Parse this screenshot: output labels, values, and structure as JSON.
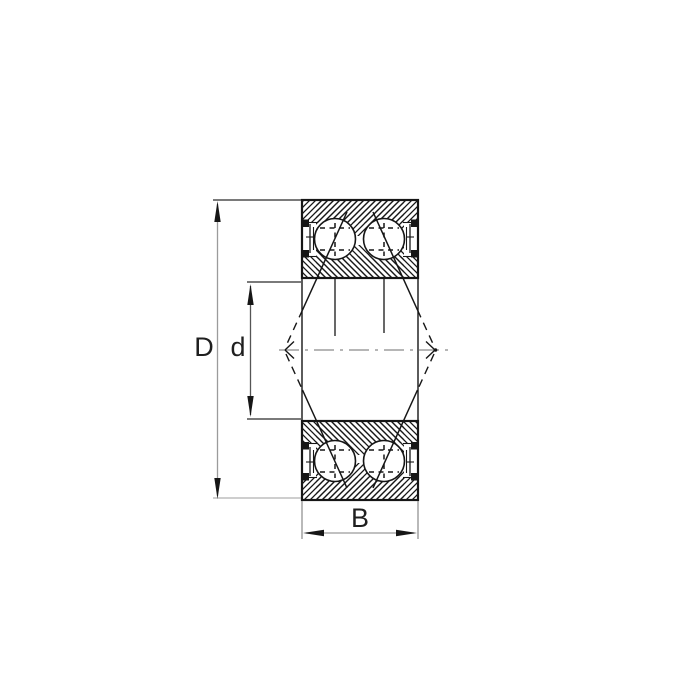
{
  "figure": {
    "dimensions": {
      "outer_diameter_label": "D",
      "bore_diameter_label": "d",
      "width_label": "B"
    },
    "colors": {
      "line": "#161616",
      "centerline": "#9e9e9e",
      "dimension_stem": "#9b9b9b",
      "background": "#ffffff"
    }
  }
}
